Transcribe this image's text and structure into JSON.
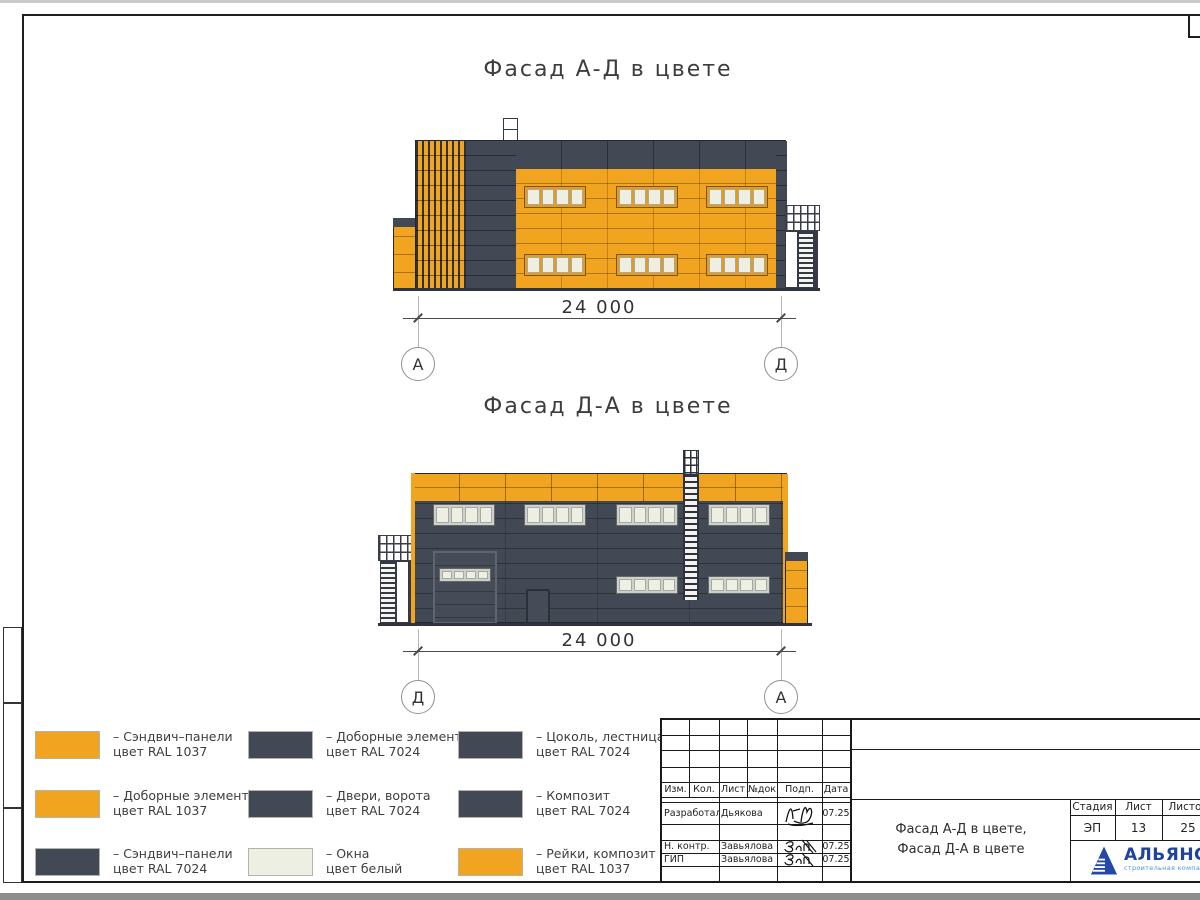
{
  "titles": {
    "facade1": "Фасад А-Д в цвете",
    "facade2": "Фасад Д-А в цвете"
  },
  "dimensions": {
    "facade1": {
      "value": "24 000",
      "axis_left": "А",
      "axis_right": "Д"
    },
    "facade2": {
      "value": "24 000",
      "axis_left": "Д",
      "axis_right": "А"
    }
  },
  "legend": {
    "items": [
      {
        "swatch": "orange",
        "line1": "– Сэндвич–панели",
        "line2": "цвет RAL 1037"
      },
      {
        "swatch": "orange",
        "line1": "– Доборные элементы",
        "line2": "цвет RAL 1037"
      },
      {
        "swatch": "dark",
        "line1": "– Сэндвич–панели",
        "line2": "цвет RAL 7024"
      },
      {
        "swatch": "dark",
        "line1": "– Доборные элементы",
        "line2": "цвет RAL 7024"
      },
      {
        "swatch": "dark",
        "line1": "– Двери, ворота",
        "line2": "цвет RAL 7024"
      },
      {
        "swatch": "window",
        "line1": "– Окна",
        "line2": "цвет белый"
      },
      {
        "swatch": "dark",
        "line1": "– Цоколь, лестница",
        "line2": "цвет RAL 7024"
      },
      {
        "swatch": "dark",
        "line1": "– Композит",
        "line2": "цвет RAL 7024"
      },
      {
        "swatch": "orange",
        "line1": "– Рейки, композит",
        "line2": "цвет RAL 1037"
      }
    ]
  },
  "titleblock": {
    "columns": [
      "Изм.",
      "Кол.",
      "Лист",
      "№док",
      "Подп.",
      "Дата"
    ],
    "rows": [
      {
        "role": "Разработал",
        "name": "Дьякова",
        "date": "07.25"
      },
      {
        "role": "Н. контр.",
        "name": "Завьялова",
        "date": "07.25"
      },
      {
        "role": "ГИП",
        "name": "Завьялова",
        "date": "07.25"
      }
    ],
    "doc_title_line1": "Фасад А-Д в цвете,",
    "doc_title_line2": "Фасад Д-А в цвете",
    "stage_headers": [
      "Стадия",
      "Лист",
      "Листов"
    ],
    "stage_values": [
      "ЭП",
      "13",
      "25"
    ],
    "logo_text": "АЛЬЯНС",
    "logo_subtitle": "строительная компания"
  },
  "colors": {
    "orange": "#F0A41F",
    "dark": "#424854",
    "window": "#EDEFE3",
    "logo_blue": "#2143A0",
    "logo_light": "#4D94D9"
  }
}
